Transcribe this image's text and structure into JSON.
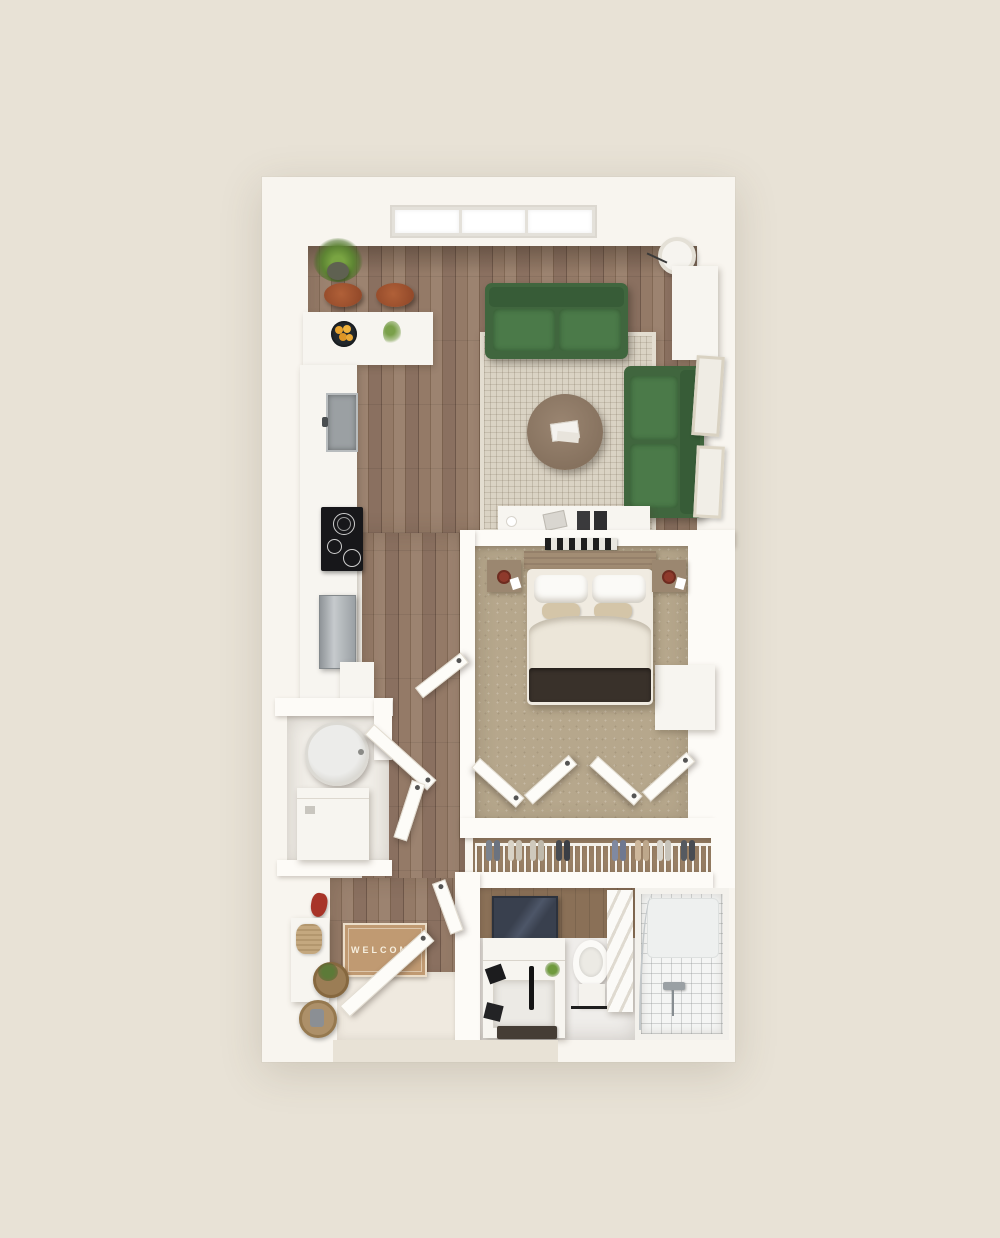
{
  "scene": {
    "title": "apartment-3d-floor-plan",
    "doormat_text": "WELCOME"
  },
  "palette": {
    "background": "#e8e2d6",
    "wall_white": "#fdfbf7",
    "plan_white": "#f8f5ef",
    "wood_floor": "#8d7462",
    "bedroom_carpet": "#b6a78c",
    "closet_floor": "#9a8166",
    "area_rug": "#dad3c4",
    "sofa_green": "#40663e",
    "stool_leather": "#9c5130",
    "cooktop_black": "#17171a",
    "stainless_steel": "#aeb3b6",
    "doormat_tan": "#c09a72",
    "throw_blanket": "#39312a",
    "mirror_stone": "#39404e",
    "tile_white": "#f4f5f4",
    "plant_green": "#6f9a3d",
    "fruit_orange": "#e8a22d",
    "coat_red": "#a83428"
  },
  "rooms": {
    "living_room": {
      "items": [
        "green-sofa",
        "green-loveseat",
        "area-rug",
        "round-coffee-table",
        "floor-lamp",
        "media-console",
        "side-cabinet",
        "leaning-picture-frames",
        "triple-window"
      ]
    },
    "kitchen": {
      "items": [
        "l-shaped-counter",
        "two-bar-stools",
        "fruit-bowl",
        "flower-sprig",
        "potted-plant",
        "sink",
        "cooktop",
        "stainless-appliance",
        "base-cabinet"
      ]
    },
    "bedroom": {
      "items": [
        "double-bed",
        "wood-headboard",
        "two-nightstands",
        "dark-throw-blanket",
        "bifold-closet-doors",
        "built-in-wardrobe"
      ]
    },
    "closet": {
      "items": [
        "wire-shoe-rack",
        "eight-pairs-of-shoes"
      ]
    },
    "bathroom": {
      "items": [
        "vanity-with-black-faucet",
        "dark-stone-mirror",
        "toilet",
        "towel-shelf",
        "tub-shower-with-glass-panel",
        "bath-mat"
      ]
    },
    "laundry_closet": {
      "items": [
        "round-top-washer",
        "dryer-unit"
      ]
    },
    "entry": {
      "items": [
        "welcome-doormat",
        "entry-door",
        "red-coat-hook",
        "storage-baskets",
        "plant-basket",
        "console-shelf"
      ]
    }
  }
}
